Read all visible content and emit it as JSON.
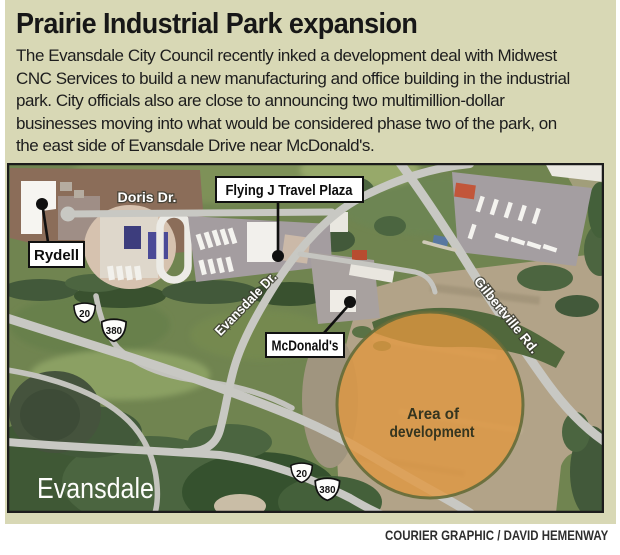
{
  "header": {
    "title": "Prairie Industrial Park expansion",
    "body_lines": [
      "The Evansdale City Council recently inked a development deal with Midwest",
      "CNC Services to build a new manufacturing and office building in the industrial",
      "park. City officials also are close to announcing two multimillion-dollar",
      "businesses moving into what would be considered phase two of the park, on",
      "the east side of Evansdale Drive near McDonald's."
    ]
  },
  "map": {
    "labels": {
      "rydell": "Rydell",
      "flying_j": "Flying J Travel Plaza",
      "mcdonalds": "McDonald's",
      "doris": "Doris Dr.",
      "evansdale_dr": "Evansdale Dr.",
      "gilbertville": "Gilbertville Rd.",
      "city": "Evansdale",
      "area_line1": "Area of",
      "area_line2": "development"
    },
    "shields": {
      "hwy20": "20",
      "hwy380": "380"
    },
    "colors": {
      "panel_background": "#d8d8b5",
      "development_area": "#e2973f",
      "road": "#c8c8c3",
      "field_green": "#708450",
      "field_tan": "#b2a388"
    }
  },
  "footer": {
    "credit": "COURIER GRAPHIC / DAVID HEMENWAY"
  }
}
